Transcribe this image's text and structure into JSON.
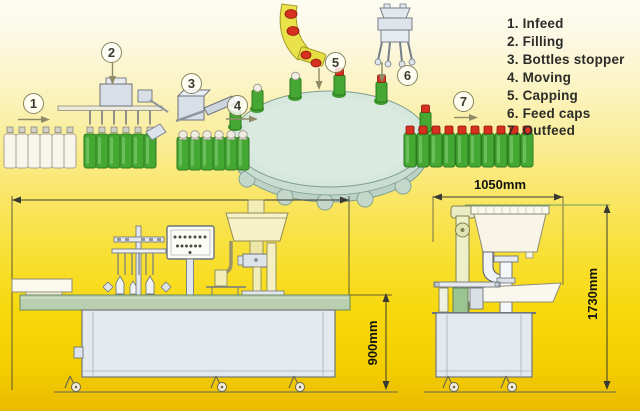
{
  "legend": {
    "items": [
      "1. Infeed",
      "2. Filling",
      "3. Bottles stopper",
      "4. Moving",
      "5. Capping",
      "6. Feed caps",
      "7. Outfeed"
    ]
  },
  "steps": [
    "1",
    "2",
    "3",
    "4",
    "5",
    "6",
    "7"
  ],
  "dimensions": {
    "machine_width": "1050mm",
    "conveyor_height": "900mm",
    "machine_height": "1730mm"
  },
  "colors": {
    "bottle_green": "#44a832",
    "cap_red": "#d6301e",
    "chute_yellow": "#e9e24a",
    "turntable_green": "#d6e7dd",
    "conveyor_green": "#b9cfb0",
    "background_yellow": "#f7d80c"
  }
}
